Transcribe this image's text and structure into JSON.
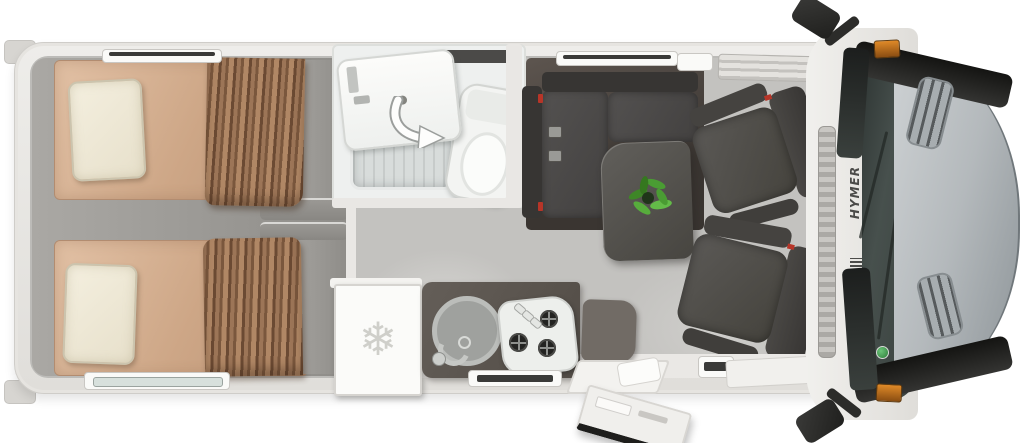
{
  "brand": {
    "side_logo": "HYMER"
  },
  "icons": {
    "fridge_name": "snowflake-icon",
    "fridge_glyph": "❄",
    "shower_arrow_name": "swivel-arrow-icon"
  },
  "colors": {
    "body_white": "#ecebe8",
    "mattress_tan": "#d0a98c",
    "pillow_cream": "#f0ead8",
    "curtain_brown": "#8a6549",
    "upholstery_charcoal": "#45433f",
    "kitchen_counter_grey": "#5d5751",
    "floor_light_grey": "#c2c1be",
    "hood_silver": "#b7bcc0",
    "windshield_glass": "#3f4744",
    "marker_orange": "#d57d22",
    "seatbelt_red": "#b73528",
    "plant_green": "#4a9c33"
  }
}
